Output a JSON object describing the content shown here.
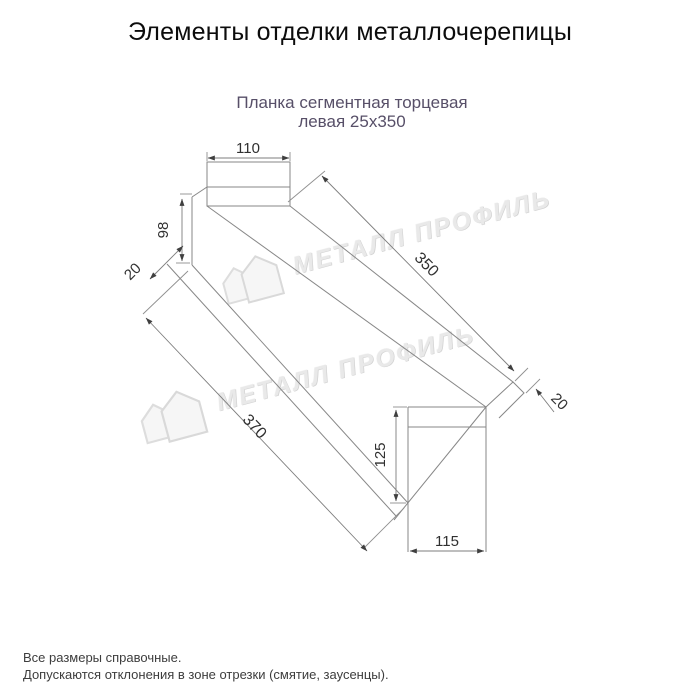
{
  "page": {
    "title": "Элементы отделки металлочерепицы",
    "subtitle_line1": "Планка сегментная торцевая",
    "subtitle_line2": "левая 25x350"
  },
  "drawing": {
    "name": "Планка сегментная торцевая левая 25x350",
    "dims": {
      "top_width": "110",
      "left_height": "98",
      "left_hem": "20",
      "top_length": "350",
      "bottom_length": "370",
      "right_hem": "20",
      "right_height": "125",
      "bottom_width": "115"
    }
  },
  "watermark": {
    "text": "МЕТАЛЛ ПРОФИЛЬ"
  },
  "footer": {
    "line1": "Все размеры справочные.",
    "line2": "Допускаются отклонения в зоне отрезки (смятие, заусенцы)."
  },
  "colors": {
    "line": "#878787",
    "arrow": "#3f3f3f",
    "dim_text": "#303030",
    "subtitle": "#574f68",
    "watermark": "#e9e9e9"
  }
}
